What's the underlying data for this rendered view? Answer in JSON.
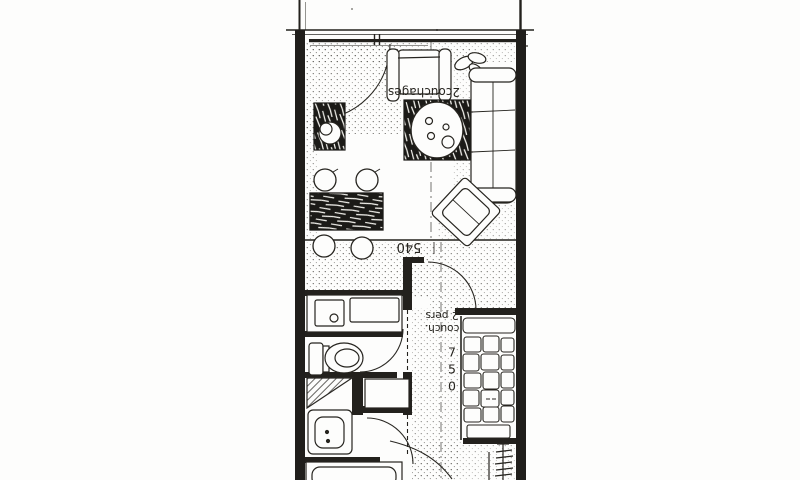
{
  "plan": {
    "type": "scanned studio apartment floor plan, drawn rotated 180 degrees",
    "colors": {
      "paper": "#fdfdfc",
      "ink": "#23211d",
      "scan_speckle": "#4a4843"
    },
    "labels": {
      "sleeps": "2couchages",
      "dim_width": "540",
      "bed_caption_line1": "couch.",
      "bed_caption_line2": "2 pers",
      "dim_length": "750"
    }
  }
}
